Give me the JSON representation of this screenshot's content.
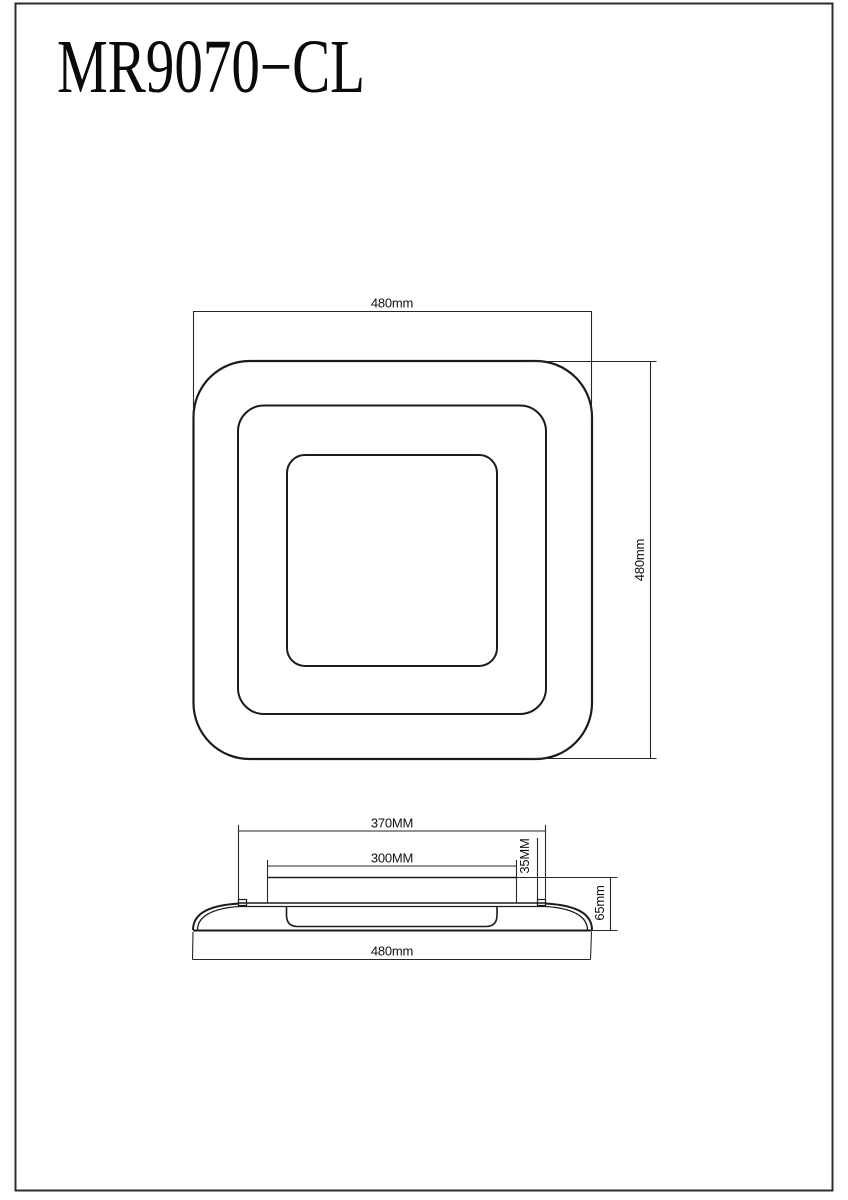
{
  "title": "MR9070−CL",
  "colors": {
    "background": "#ffffff",
    "line": "#1b1b1b",
    "dimension_line": "#262626",
    "text": "#111111"
  },
  "top_view": {
    "width_label": "480mm",
    "height_label": "480mm"
  },
  "side_view": {
    "top_width_label": "370MM",
    "inner_panel_width_label": "300MM",
    "mount_height_label": "35MM",
    "overall_height_label": "65mm",
    "base_width_label": "480mm"
  }
}
